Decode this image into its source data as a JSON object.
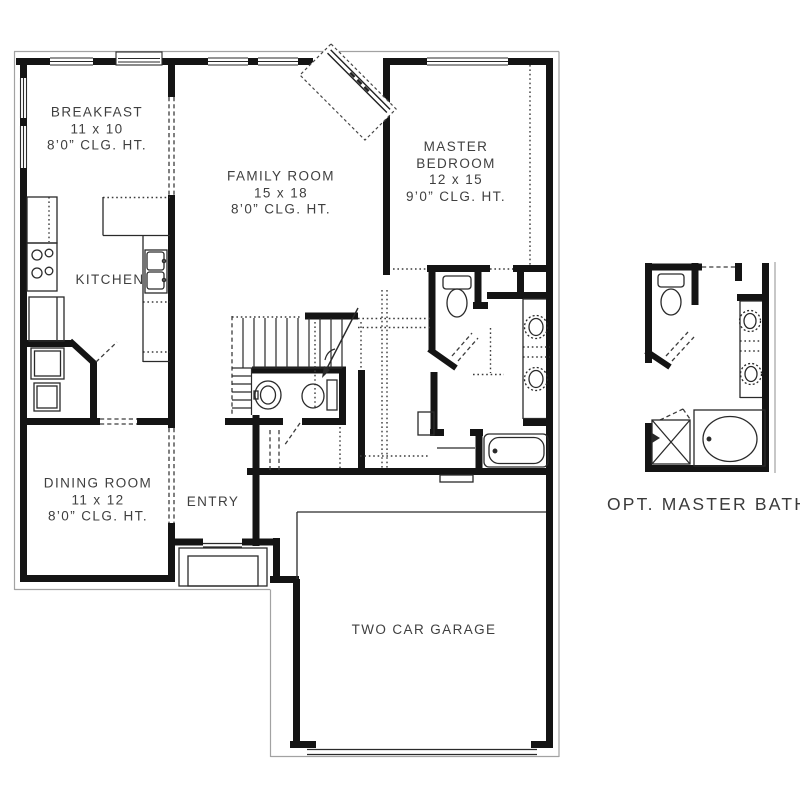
{
  "plan": {
    "type": "first-floor-plan",
    "rooms": [
      {
        "id": "breakfast",
        "name": "BREAKFAST",
        "dimensions": "11 x 10",
        "ceiling_height": "8’0” CLG. HT."
      },
      {
        "id": "family-room",
        "name": "FAMILY ROOM",
        "dimensions": "15 x 18",
        "ceiling_height": "8’0” CLG. HT."
      },
      {
        "id": "master-bedroom",
        "name": "MASTER BEDROOM",
        "name_line1": "MASTER",
        "name_line2": "BEDROOM",
        "dimensions": "12 x 15",
        "ceiling_height": "9’0” CLG. HT."
      },
      {
        "id": "kitchen",
        "name": "KITCHEN"
      },
      {
        "id": "dining-room",
        "name": "DINING ROOM",
        "dimensions": "11 x 12",
        "ceiling_height": "8’0” CLG. HT."
      },
      {
        "id": "entry",
        "name": "ENTRY"
      },
      {
        "id": "garage",
        "name": "TWO CAR GARAGE"
      },
      {
        "id": "opt-master-bath",
        "name": "OPT. MASTER BATH"
      }
    ],
    "fixtures": [
      "corner-fireplace-icon",
      "staircase-icon",
      "range-icon",
      "refrigerator-icon",
      "kitchen-double-sink-icon",
      "washer-icon",
      "dryer-icon",
      "pedestal-sink-icon",
      "toilet-icon",
      "vanity-double-sink-icon",
      "bathtub-icon",
      "garden-tub-icon",
      "shower-icon",
      "bench-icon",
      "porch-stoop-icon",
      "garage-door-icon",
      "window-icon"
    ],
    "colors": {
      "background": "#ffffff",
      "walls": "#141414",
      "thin_lines": "#2a2a2a",
      "dashed_lines": "#3c3c3c",
      "face_lines": "#a2a2a2",
      "label_text": "#3f3f3f"
    }
  }
}
